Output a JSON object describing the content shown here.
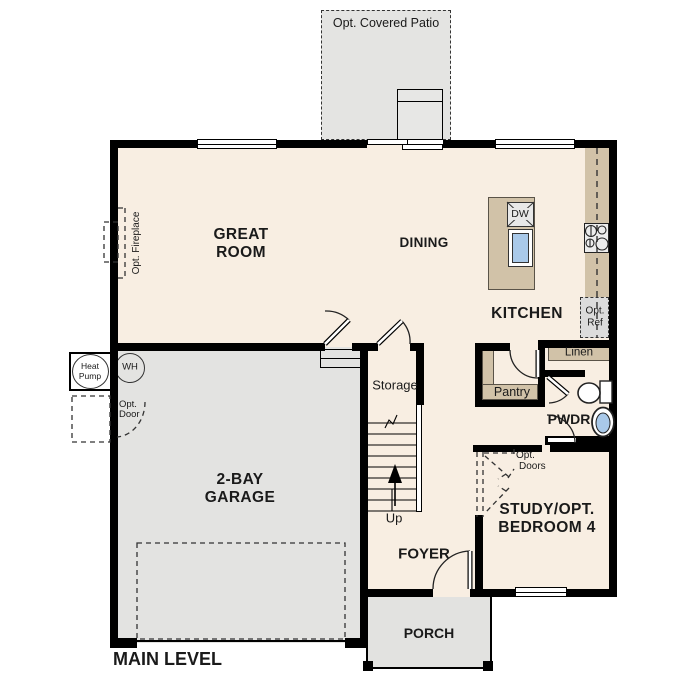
{
  "title": {
    "label": "MAIN LEVEL"
  },
  "patio": {
    "label": "Opt. Covered Patio"
  },
  "rooms": {
    "great_room": {
      "line1": "GREAT",
      "line2": "ROOM"
    },
    "dining": {
      "label": "DINING"
    },
    "kitchen": {
      "label": "KITCHEN"
    },
    "garage": {
      "line1": "2-BAY",
      "line2": "GARAGE"
    },
    "storage": {
      "label": "Storage"
    },
    "stairs": {
      "direction": "Up"
    },
    "pantry": {
      "label": "Pantry"
    },
    "linen": {
      "label": "Linen"
    },
    "powder": {
      "label": "PWDR"
    },
    "study": {
      "line1": "STUDY/OPT.",
      "line2": "BEDROOM 4"
    },
    "foyer": {
      "label": "FOYER"
    },
    "porch": {
      "label": "PORCH"
    }
  },
  "fixtures": {
    "dishwasher": "DW",
    "water_heater": "WH"
  },
  "options": {
    "fireplace": "Opt. Fireplace",
    "heat_pump_line1": "Heat",
    "heat_pump_line2": "Pump",
    "door_line1": "Opt.",
    "door_line2": "Door",
    "ref_line1": "Opt.",
    "ref_line2": "Ref",
    "doors_line1": "Opt.",
    "doors_line2": "Doors"
  },
  "colors": {
    "floor": "#f8eee2",
    "garage": "#e3e3e1",
    "casework": "#d1c2a8",
    "wall": "#000000",
    "fixture_blue": "#a9c9e9"
  }
}
